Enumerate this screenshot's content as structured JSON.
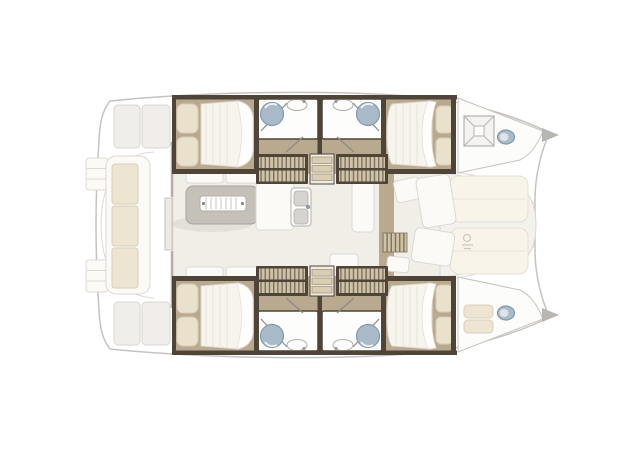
{
  "figure": {
    "type": "catamaran-floor-plan",
    "orientation": "bow-right",
    "areas": [
      "cockpit",
      "salon",
      "galley",
      "port-hull",
      "starboard-hull",
      "foredeck"
    ],
    "cabin_count": 4,
    "bathroom_count": 4,
    "fixtures": [
      "double-bed",
      "pillows",
      "shower-basin",
      "washbasin",
      "toilet",
      "companionway-stairs",
      "dinette-table",
      "dinette-seats",
      "galley-sink",
      "cockpit-bench",
      "transom-steps",
      "deck-hatch",
      "sunpads",
      "windlass"
    ]
  },
  "palette": {
    "hull_fill": "#ffffff",
    "line": "#c6c3bf",
    "line_light": "#dcd9d4",
    "panel": "#efeeeb",
    "panel_line": "#d9d7d3",
    "trim": "#4e4438",
    "wood": "#b8a98f",
    "stair_light": "#cec2a7",
    "stair_dark": "#7e7260",
    "salon_floor": "#f1eee8",
    "cushion": "#ede5d2",
    "cushion_border": "#d9cfb8",
    "mattress": "#f6f4ed",
    "duvet": "#fefdfb",
    "pillow": "#eae1cc",
    "table": "#c6c1b8",
    "furniture_white": "#fbfaf7",
    "fixture": "#a9bac9",
    "fixture_edge": "#8299ac",
    "sink": "#fdfdfc",
    "sunpad": "#f8f4ea",
    "foredeck": "#f3f2ee"
  }
}
